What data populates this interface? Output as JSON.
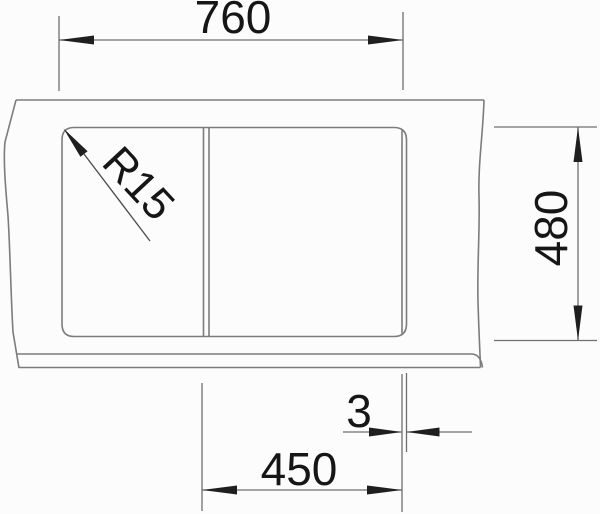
{
  "drawing": {
    "type": "technical-dimension-drawing",
    "subject": "sink-top-view",
    "labels": {
      "overall_width": "760",
      "depth": "480",
      "edge_gap": "3",
      "bowl_width": "450",
      "corner_radius": "R15"
    },
    "colors": {
      "outline": "#7c7c7c",
      "dimension_line": "#6f6f6f",
      "arrow": "#1f1f1f",
      "text": "#161616",
      "background": "#fcfcfc"
    }
  }
}
